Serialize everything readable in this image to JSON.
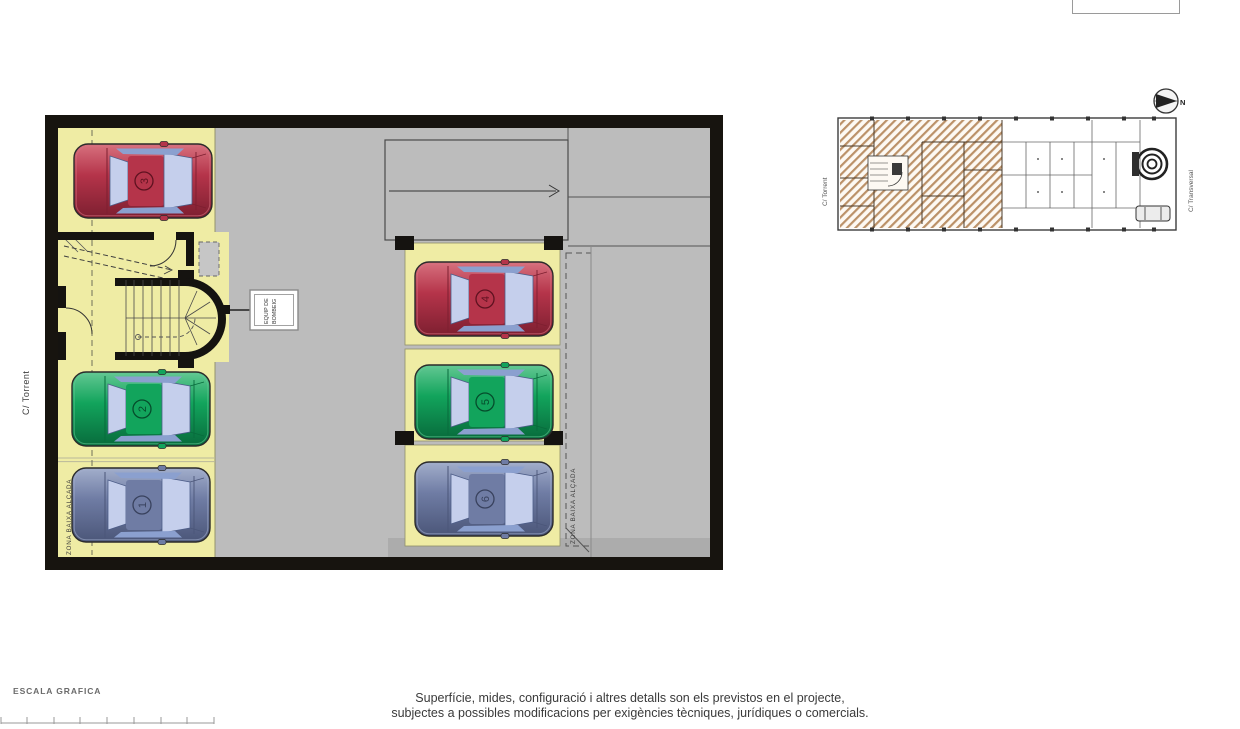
{
  "palette": {
    "yellow_spot": "#efeca4",
    "floor_gray": "#bcbcbc",
    "wall_black": "#17140f",
    "hatch_tan": "#bb9168",
    "glass": "#c5cfec",
    "glass_dark": "#8ba0cf",
    "glass_stroke": "#4d5d88",
    "red": {
      "light": "#d7717e",
      "body": "#b5344a",
      "dark": "#7d1f30",
      "accent": "#5f1220"
    },
    "green": {
      "light": "#63c893",
      "body": "#12a45c",
      "dark": "#086b3c",
      "accent": "#054d2c"
    },
    "blue": {
      "light": "#a2aecb",
      "body": "#6f7ca4",
      "dark": "#4b5679",
      "accent": "#39425e"
    }
  },
  "main_plan": {
    "street_label": "C/ Torrent",
    "zone_label_left": "ZONA BAIXA ALÇADA",
    "zone_label_right": "ZONA BAIXA ALÇADA",
    "equip_label_line1": "EQUIP DE",
    "equip_label_line2": "BOMBEIG",
    "spots": [
      {
        "number": "3",
        "color": "red",
        "position": "left-top"
      },
      {
        "number": "2",
        "color": "green",
        "position": "left-middle"
      },
      {
        "number": "1",
        "color": "blue",
        "position": "left-bottom"
      },
      {
        "number": "4",
        "color": "red",
        "position": "center-top"
      },
      {
        "number": "5",
        "color": "green",
        "position": "center-middle"
      },
      {
        "number": "6",
        "color": "blue",
        "position": "center-bottom"
      }
    ]
  },
  "overview_plan": {
    "street_label_left": "C/ Torrent",
    "street_label_right": "C/ Transversal",
    "north_label": "N"
  },
  "footer": {
    "scale_label": "ESCALA GRAFICA",
    "disclaimer_line1": "Superfície, mides, configuració i altres detalls son els previstos en el projecte,",
    "disclaimer_line2": "subjectes a possibles modificacions per exigències tècniques, jurídiques o comercials."
  }
}
